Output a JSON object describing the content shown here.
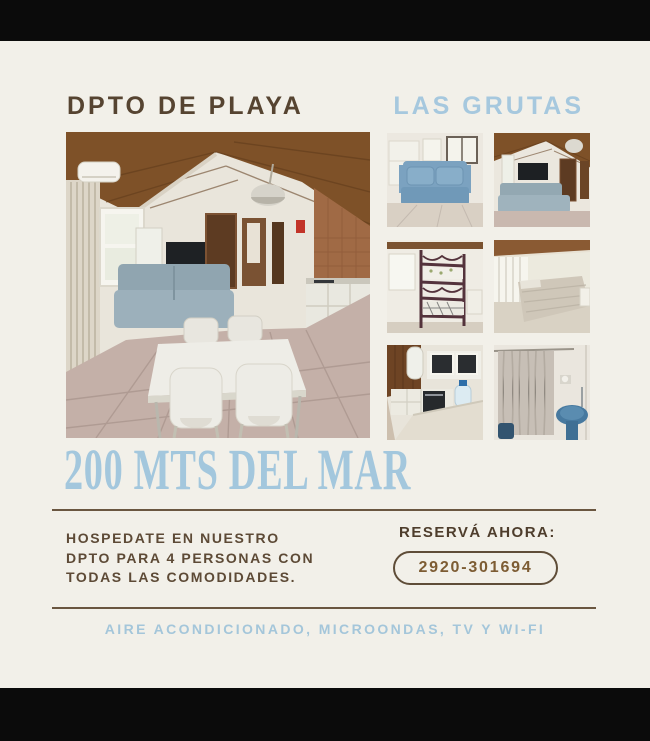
{
  "page": {
    "frame_color": "#0b0b0b",
    "canvas_color": "#f2f0e9"
  },
  "header": {
    "title_left": "DPTO DE PLAYA",
    "title_right": "LAS GRUTAS"
  },
  "headline": {
    "text": "200 MTS DEL MAR"
  },
  "description": {
    "lines": [
      "HOSPEDATE EN NUESTRO",
      "DPTO PARA 4 PERSONAS CON",
      "TODAS LAS COMODIDADES."
    ]
  },
  "reserve": {
    "label": "RESERVÁ AHORA:",
    "phone": "2920-301694"
  },
  "amenities": {
    "text": "AIRE ACONDICIONADO, MICROONDAS, TV Y WI-FI"
  },
  "colors": {
    "title_brown": "#564431",
    "body_brown": "#5d4a36",
    "phone_gold": "#7d5c33",
    "accent_blue": "#a6c8de",
    "divider_brown": "#6a5640",
    "background_cream": "#f2f0e9",
    "letterbox_black": "#0b0b0b"
  },
  "photos": {
    "main": "dining-kitchen-overview",
    "grid": [
      "blue-sofa-living",
      "living-room-tv",
      "bunk-bed-room",
      "double-bed-bedroom",
      "kitchen-corner",
      "bathroom-shower"
    ]
  }
}
